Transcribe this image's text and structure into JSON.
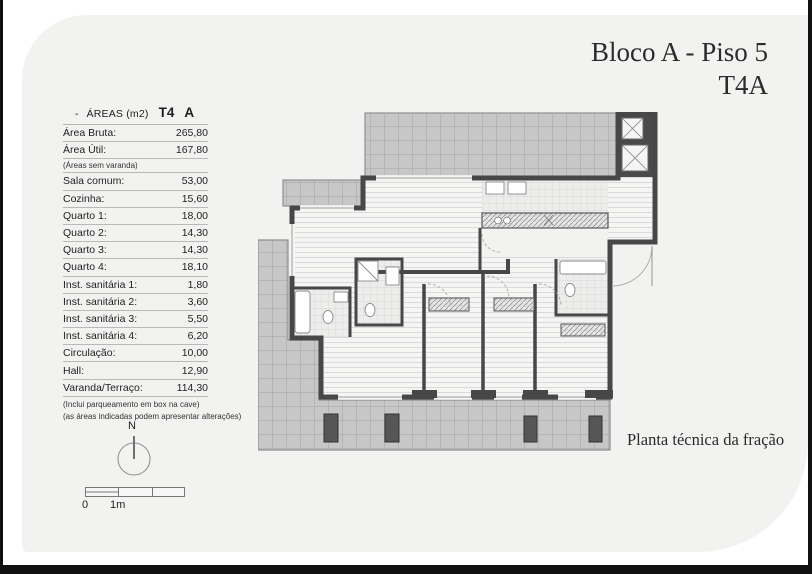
{
  "title": {
    "line1": "Bloco A - Piso 5",
    "line2": "T4A"
  },
  "caption": "Planta técnica da fração",
  "table": {
    "header": {
      "dash": "-",
      "name": "ÁREAS (m2)",
      "type": "T4",
      "letter": "A"
    },
    "rows": [
      {
        "label": "Área Bruta:",
        "value": "265,80"
      },
      {
        "label": "Área Útil:",
        "value": "167,80"
      },
      {
        "label": "Sala comum:",
        "value": "53,00"
      },
      {
        "label": "Cozinha:",
        "value": "15,60"
      },
      {
        "label": "Quarto 1:",
        "value": "18,00"
      },
      {
        "label": "Quarto 2:",
        "value": "14,30"
      },
      {
        "label": "Quarto 3:",
        "value": "14,30"
      },
      {
        "label": "Quarto 4:",
        "value": "18,10"
      },
      {
        "label": "Inst. sanitária 1:",
        "value": "1,80"
      },
      {
        "label": "Inst. sanitária 2:",
        "value": "3,60"
      },
      {
        "label": "Inst. sanitária 3:",
        "value": "5,50"
      },
      {
        "label": "Inst. sanitária 4:",
        "value": "6,20"
      },
      {
        "label": "Circulação:",
        "value": "10,00"
      },
      {
        "label": "Hall:",
        "value": "12,90"
      },
      {
        "label": "Varanda/Terraço:",
        "value": "114,30"
      }
    ],
    "subnote": "(Áreas sem varanda)",
    "footnotes": [
      "(Inclui parqueamento em box na cave)",
      "(as áreas indicadas podem apresentar alterações)"
    ]
  },
  "compass": {
    "label": "N"
  },
  "scalebar": {
    "zero": "0",
    "one": "1m"
  },
  "colors": {
    "sheet_bg": "#f2f2f1",
    "wall": "#474747",
    "terrace_fill": "#c7c7c7",
    "frame": "#111111"
  }
}
